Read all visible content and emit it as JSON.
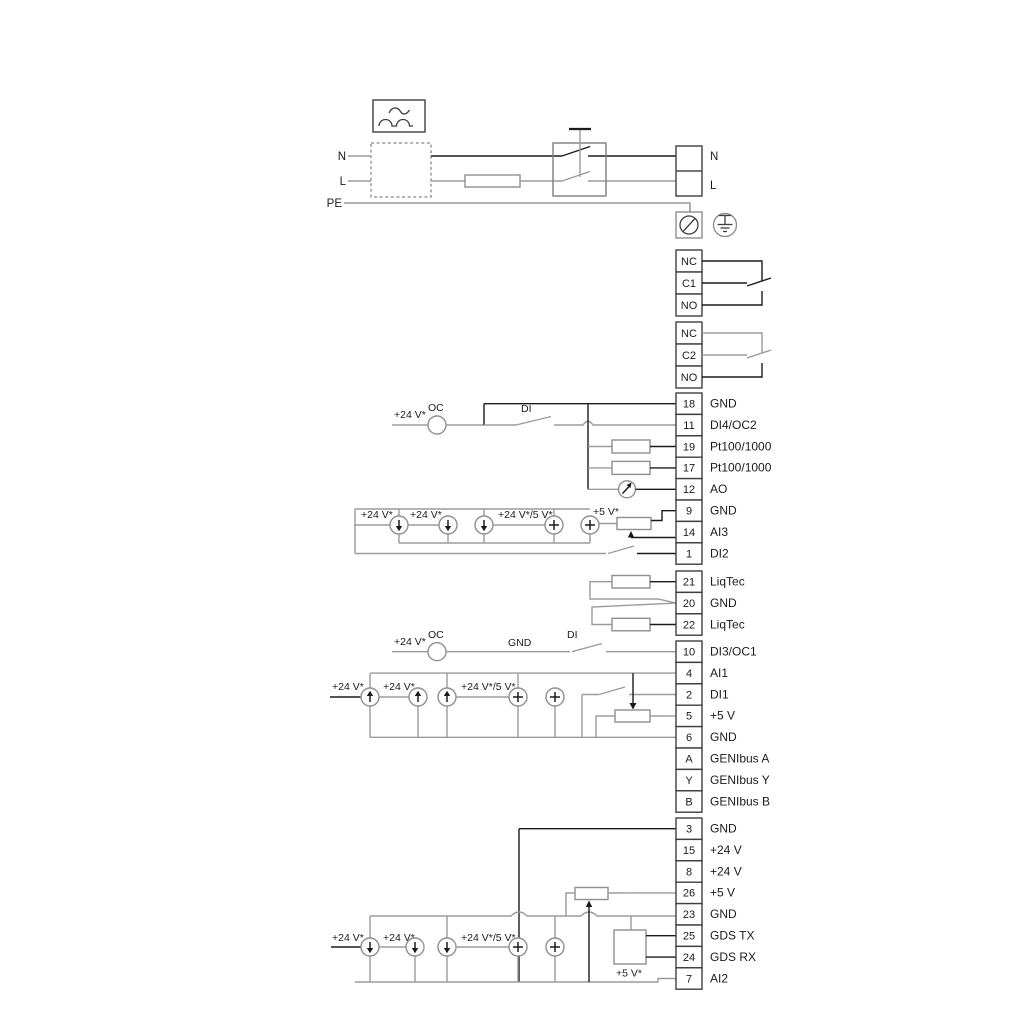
{
  "power": {
    "n": "N",
    "l": "L",
    "pe": "PE",
    "block_n": "N",
    "block_l": "L"
  },
  "relay1": {
    "rows": [
      "NC",
      "C1",
      "NO"
    ]
  },
  "relay2": {
    "rows": [
      "NC",
      "C2",
      "NO"
    ]
  },
  "g1": {
    "rows": [
      {
        "no": "18",
        "label": "GND"
      },
      {
        "no": "11",
        "label": "DI4/OC2"
      },
      {
        "no": "19",
        "label": "Pt100/1000"
      },
      {
        "no": "17",
        "label": "Pt100/1000"
      },
      {
        "no": "12",
        "label": "AO"
      },
      {
        "no": "9",
        "label": "GND"
      },
      {
        "no": "14",
        "label": "AI3"
      },
      {
        "no": "1",
        "label": "DI2"
      }
    ]
  },
  "g2": {
    "rows": [
      {
        "no": "21",
        "label": "LiqTec"
      },
      {
        "no": "20",
        "label": "GND"
      },
      {
        "no": "22",
        "label": "LiqTec"
      }
    ]
  },
  "g3": {
    "rows": [
      {
        "no": "10",
        "label": "DI3/OC1"
      },
      {
        "no": "4",
        "label": "AI1"
      },
      {
        "no": "2",
        "label": "DI1"
      },
      {
        "no": "5",
        "label": "+5 V"
      },
      {
        "no": "6",
        "label": "GND"
      },
      {
        "no": "A",
        "label": "GENIbus A"
      },
      {
        "no": "Y",
        "label": "GENIbus Y"
      },
      {
        "no": "B",
        "label": "GENIbus B"
      }
    ]
  },
  "g4": {
    "rows": [
      {
        "no": "3",
        "label": "GND"
      },
      {
        "no": "15",
        "label": "+24 V"
      },
      {
        "no": "8",
        "label": "+24 V"
      },
      {
        "no": "26",
        "label": "+5 V"
      },
      {
        "no": "23",
        "label": "GND"
      },
      {
        "no": "25",
        "label": "GDS TX"
      },
      {
        "no": "24",
        "label": "GDS RX"
      },
      {
        "no": "7",
        "label": "AI2"
      }
    ]
  },
  "s1": {
    "v24": "+24 V*",
    "oc": "OC",
    "di": "DI"
  },
  "s2": {
    "v24a": "+24 V*",
    "v24b": "+24 V*",
    "v245": "+24 V*/5 V*",
    "v5": "+5 V*"
  },
  "s3": {
    "v24": "+24 V*",
    "oc": "OC",
    "gnd": "GND",
    "di": "DI"
  },
  "s4": {
    "v24a": "+24 V*",
    "v24b": "+24 V*",
    "v245": "+24 V*/5 V*"
  },
  "s6": {
    "v24a": "+24 V*",
    "v24b": "+24 V*",
    "v245": "+24 V*/5 V*",
    "v5": "+5 V*"
  },
  "colors": {
    "wire_gray": "#9b9b9b",
    "wire_black": "#1b1b1b",
    "text": "#1b1b1b",
    "background": "#ffffff"
  }
}
